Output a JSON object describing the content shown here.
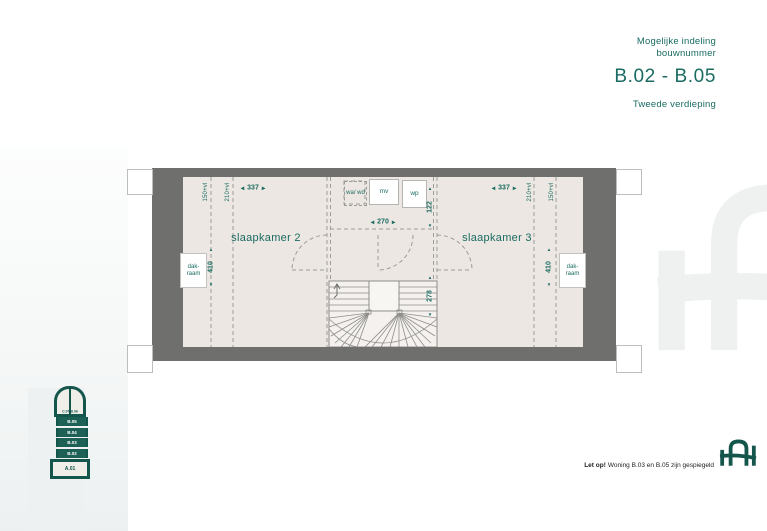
{
  "header": {
    "subtitle_line1": "Mogelijke indeling",
    "subtitle_line2": "bouwnummer",
    "bouwnummer_range": "B.02 - B.05",
    "floor_label": "Tweede verdieping"
  },
  "icons": {
    "arrow_left": "◀",
    "arrow_right": "▶",
    "arrow_up": "▲",
    "arrow_down": "▼"
  },
  "floorplan": {
    "rooms": [
      {
        "label": "slaapkamer 2"
      },
      {
        "label": "slaapkamer 3"
      }
    ],
    "fixtures": {
      "washer": "wa/ wd",
      "ventilation": "mv",
      "heatpump": "wp"
    },
    "skylight_left": "dak-raam",
    "skylight_right": "dak-raam",
    "dimensions": {
      "room_left_width": "337",
      "room_right_width": "337",
      "hall_width": "270",
      "closet_depth": "122",
      "stair_depth": "278",
      "room_left_depth": "410",
      "room_right_depth": "410",
      "knee_wall_left_outer": "150+vl",
      "knee_wall_left_inner": "210+vl",
      "knee_wall_right_inner": "210+vl",
      "knee_wall_right_outer": "150+vl"
    }
  },
  "tower": {
    "top_label": "C.07/B.06",
    "levels": [
      "B.05",
      "B.04",
      "B.03",
      "B.02"
    ],
    "base_label": "A.01"
  },
  "footer": {
    "notice_lead": "Let op!",
    "notice_text": "Woning B.03 en B.05 zijn gespiegeld"
  },
  "colors": {
    "accent_teal": "#1a6b62",
    "brand_dark_teal": "#14564c",
    "wall_gray": "#6f6f6e",
    "floor_beige": "#ece7e2"
  }
}
